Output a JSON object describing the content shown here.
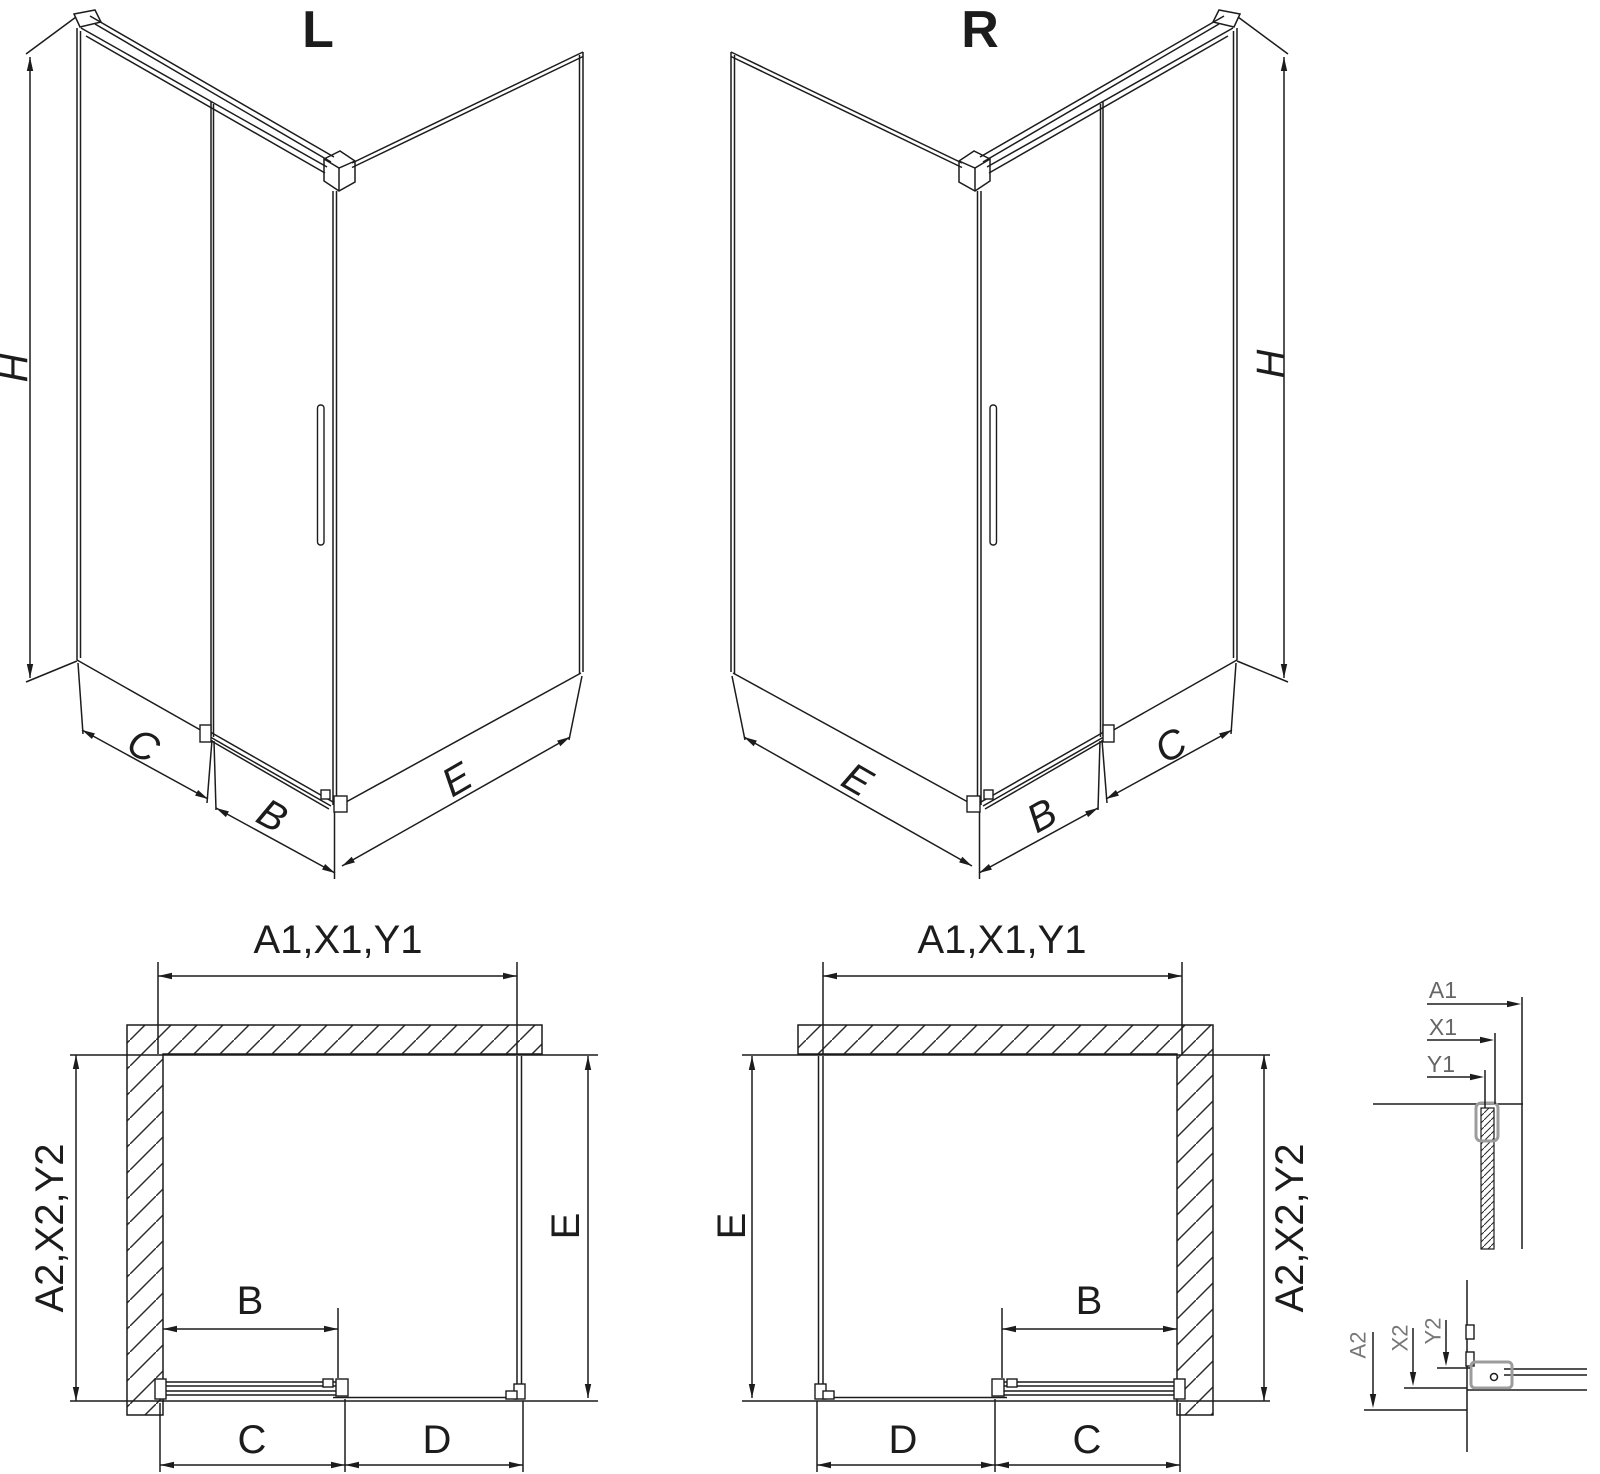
{
  "drawing_type": "shower-enclosure-technical-drawing",
  "iso_left": {
    "title": "L",
    "dim_height": "H",
    "dim_side": "C",
    "dim_door": "B",
    "dim_fixed": "E"
  },
  "iso_right": {
    "title": "R",
    "dim_height": "H",
    "dim_side": "C",
    "dim_door": "B",
    "dim_fixed": "E"
  },
  "plan_left": {
    "dim_width": "A1,X1,Y1",
    "dim_depth": "A2,X2,Y2",
    "dim_e": "E",
    "dim_b": "B",
    "dim_c": "C",
    "dim_d": "D"
  },
  "plan_right": {
    "dim_width": "A1,X1,Y1",
    "dim_depth": "A2,X2,Y2",
    "dim_e": "E",
    "dim_b": "B",
    "dim_c": "C",
    "dim_d": "D"
  },
  "detail_top": {
    "a1": "A1",
    "x1": "X1",
    "y1": "Y1"
  },
  "detail_bottom": {
    "a2": "A2",
    "x2": "X2",
    "y2": "Y2"
  },
  "colors": {
    "line": "#1c1c1c",
    "profile_gray": "#9c9c9c",
    "detail_label_gray": "#666666",
    "background": "#ffffff"
  }
}
